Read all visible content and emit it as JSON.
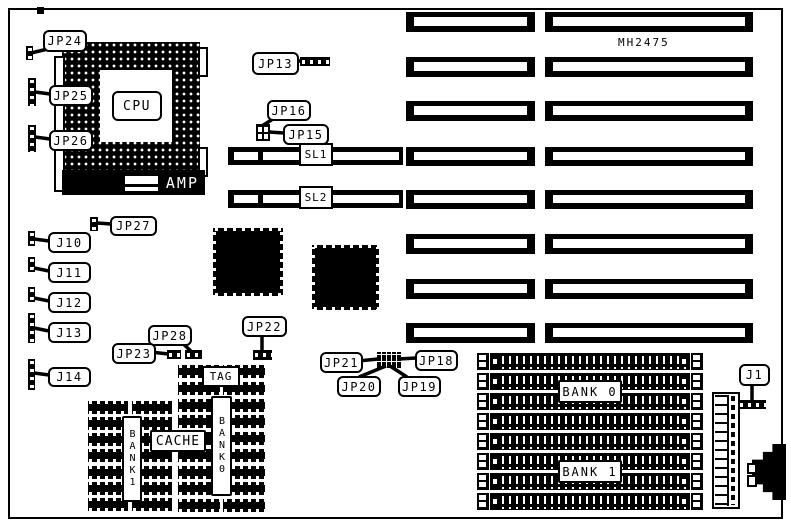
{
  "board": {
    "part_number": "MH2475"
  },
  "cpu": {
    "label": "CPU",
    "amp_label": "AMP"
  },
  "slots": {
    "sl1": "SL1",
    "sl2": "SL2"
  },
  "jumpers": {
    "jp24": "JP24",
    "jp25": "JP25",
    "jp26": "JP26",
    "jp13": "JP13",
    "jp16": "JP16",
    "jp15": "JP15",
    "jp27": "JP27",
    "j10": "J10",
    "j11": "J11",
    "j12": "J12",
    "j13": "J13",
    "j14": "J14",
    "jp28": "JP28",
    "jp23": "JP23",
    "jp22": "JP22",
    "jp21": "JP21",
    "jp18": "JP18",
    "jp20": "JP20",
    "jp19": "JP19",
    "j1": "J1"
  },
  "cache": {
    "tag": "TAG",
    "label": "CACHE",
    "bank0": "BANK0",
    "bank1": "BANK1"
  },
  "memory": {
    "bank0": "BANK 0",
    "bank1": "BANK 1"
  }
}
